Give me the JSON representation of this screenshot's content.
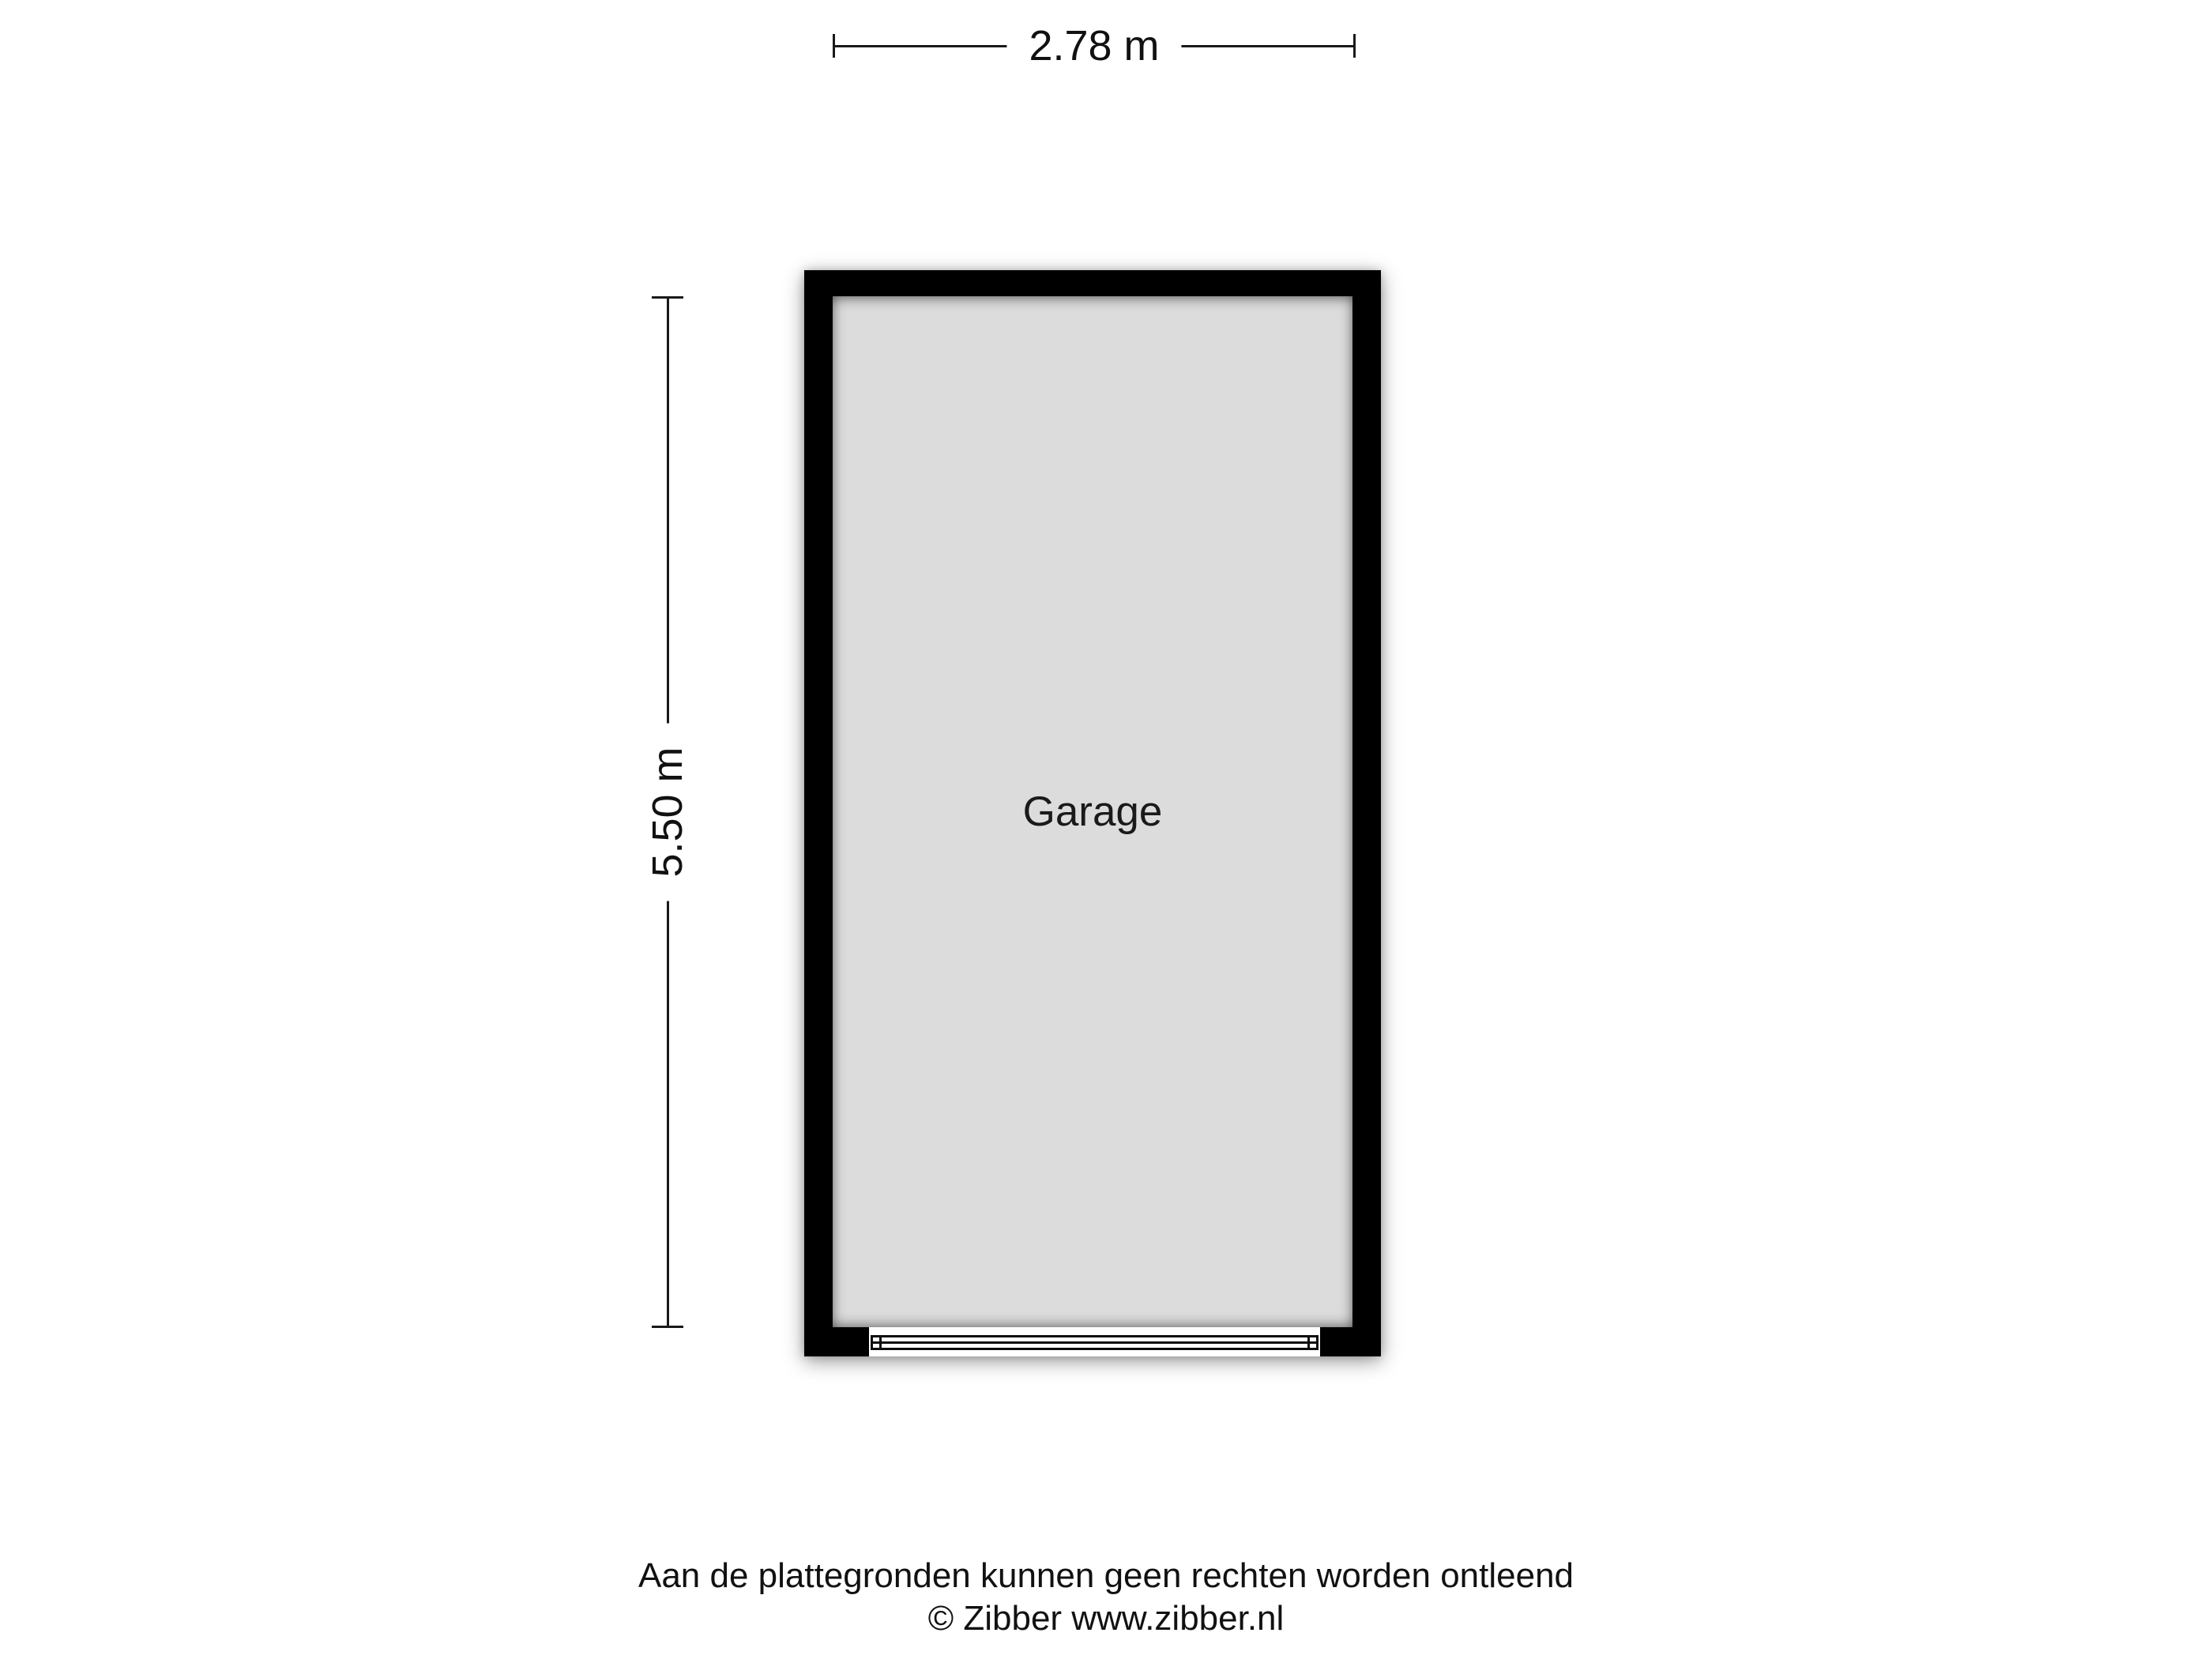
{
  "floorplan": {
    "room": {
      "name": "Garage"
    },
    "dimensions": {
      "width_label": "2.78 m",
      "height_label": "5.50 m"
    }
  },
  "footer": {
    "disclaimer": "Aan de plattegronden kunnen geen rechten worden ontleend",
    "copyright": "© Zibber www.zibber.nl"
  },
  "colors": {
    "wall": "#000000",
    "floor_fill": "#dcdcdc",
    "dimension_line": "#1a1a1a",
    "text": "#111111",
    "background": "#ffffff"
  }
}
